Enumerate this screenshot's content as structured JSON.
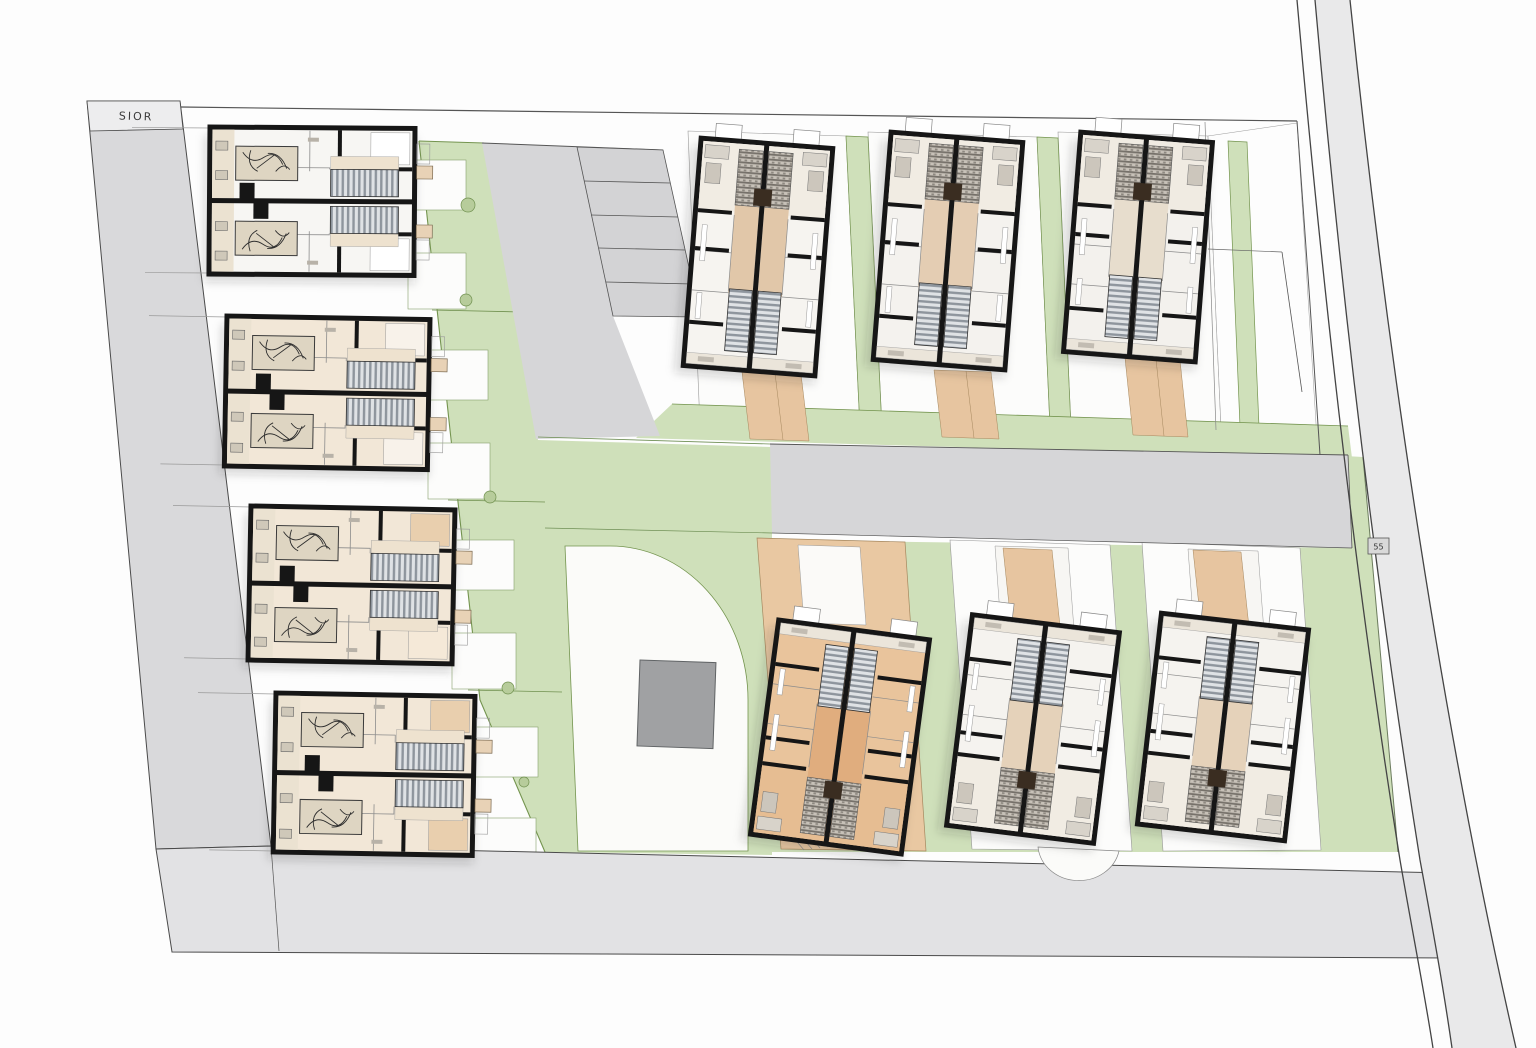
{
  "labels": {
    "road_name": "SIOR",
    "plot_marker": "55"
  },
  "colors": {
    "wall": "#161616",
    "bed": "#ded5c2",
    "left_strip": "#ebe2d1",
    "step_box": "#e8d2b6",
    "chimney_brown": "#3a2d21",
    "green": "#cfe0ba",
    "green_edge": "#74944f",
    "road": "#d6d6d8",
    "road_light": "#e2e2e4",
    "ring_road": "#e9e9ea",
    "tan_path": "#e7c5a0",
    "plot_white": "#fcfcfb",
    "shed": "#a0a1a3"
  },
  "site": {
    "parking_stalls": 5,
    "buildings": {
      "left_row": [
        {
          "id": "L1",
          "x": 210,
          "y": 127,
          "w": 205,
          "h": 147,
          "rot": 0.4,
          "fill": "#f7f6f3",
          "topRight": "#ffffff",
          "bottomRight": "#ffffff"
        },
        {
          "id": "L2",
          "x": 227,
          "y": 316,
          "w": 203,
          "h": 150,
          "rot": 1.0,
          "fill": "#f2e7d7",
          "topRight": "#f8f2ea",
          "bottomRight": "#f8f2ea"
        },
        {
          "id": "L3",
          "x": 251,
          "y": 506,
          "w": 204,
          "h": 154,
          "rot": 1.1,
          "fill": "#f2e7d7",
          "topRight": "#e9cfae",
          "bottomRight": "#f5e9d8"
        },
        {
          "id": "L4",
          "x": 276,
          "y": 693,
          "w": 199,
          "h": 159,
          "rot": 1.0,
          "fill": "#f2e7d7",
          "topRight": "#e9cfae",
          "bottomRight": "#e9cfae"
        }
      ],
      "north_row": [
        {
          "id": "N1",
          "cx": 758,
          "cy": 257,
          "w": 132,
          "h": 228,
          "rot": 4.5,
          "flip": false,
          "fill": "#f6f4f0",
          "corridor": "#e1c7a9",
          "kz": "#f1ece3"
        },
        {
          "id": "N2",
          "cx": 948,
          "cy": 251,
          "w": 132,
          "h": 228,
          "rot": 4.5,
          "flip": false,
          "fill": "#f4f2ee",
          "corridor": "#e4cdb3",
          "kz": "#f1ece3"
        },
        {
          "id": "N3",
          "cx": 1138,
          "cy": 247,
          "w": 132,
          "h": 220,
          "rot": 4.5,
          "flip": false,
          "fill": "#f3f1ed",
          "corridor": "#e7ddcd",
          "kz": "#f0ebe2"
        }
      ],
      "south_row": [
        {
          "id": "S1",
          "cx": 840,
          "cy": 737,
          "w": 152,
          "h": 216,
          "rot": 7.5,
          "flip": true,
          "fill": "#e9c49c",
          "corridor": "#e0ad7e",
          "kz": "#e6bd92"
        },
        {
          "id": "S2",
          "cx": 1033,
          "cy": 729,
          "w": 148,
          "h": 212,
          "rot": 7.0,
          "flip": true,
          "fill": "#f5f3ef",
          "corridor": "#e5d2ba",
          "kz": "#f1ece3"
        },
        {
          "id": "S3",
          "cx": 1223,
          "cy": 727,
          "w": 148,
          "h": 212,
          "rot": 6.5,
          "flip": true,
          "fill": "#f5f3ef",
          "corridor": "#e5d2ba",
          "kz": "#f1ece3"
        }
      ]
    }
  }
}
